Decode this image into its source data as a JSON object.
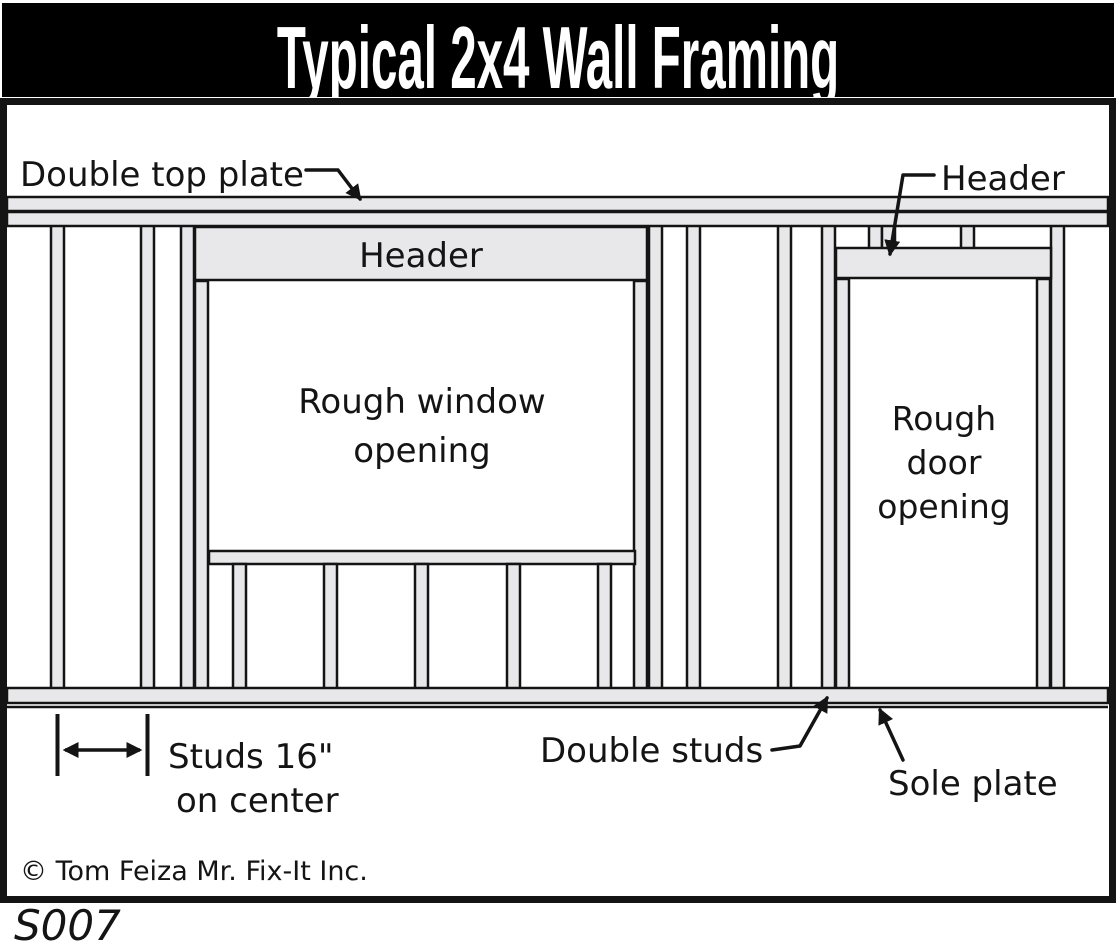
{
  "title": "Typical 2x4 Wall Framing",
  "code": "S007",
  "copyright": "© Tom Feiza Mr. Fix-It Inc.",
  "colors": {
    "title_bg": "#000000",
    "title_fg": "#ffffff",
    "wood": "#e8e8ea",
    "outline": "#141414"
  },
  "labels": {
    "double_top_plate": "Double top plate",
    "header_door": "Header",
    "header_window": "Header",
    "rough_window_line1": "Rough window",
    "rough_window_line2": "opening",
    "rough_door_line1": "Rough",
    "rough_door_line2": "door",
    "rough_door_line3": "opening",
    "studs_line1": "Studs 16\"",
    "studs_line2": "on center",
    "double_studs": "Double studs",
    "sole_plate": "Sole plate"
  }
}
